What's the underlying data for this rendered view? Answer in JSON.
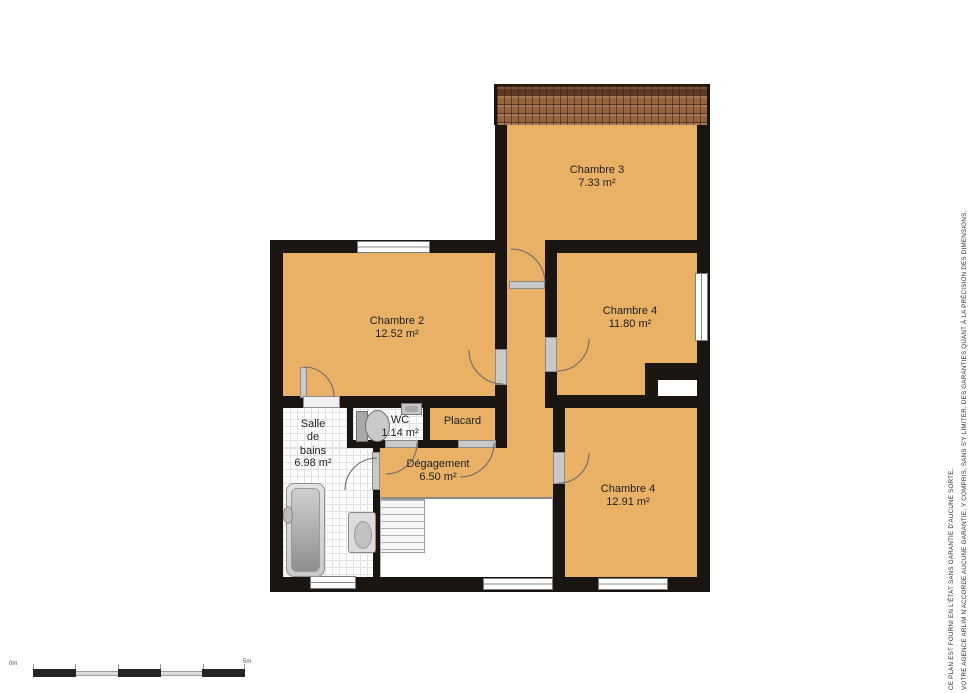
{
  "rooms": [
    {
      "label": "Chambre 3",
      "area": "7.33 m²"
    },
    {
      "label": "Chambre 2",
      "area": "12.52 m²"
    },
    {
      "label": "Chambre 4",
      "area": "11.80 m²"
    },
    {
      "label": "Chambre 4",
      "area": "12.91 m²"
    },
    {
      "label": "Salle de bains",
      "area": "6.98 m²"
    },
    {
      "label": "WC",
      "area": "1.14 m²"
    },
    {
      "label": "Placard",
      "area": ""
    },
    {
      "label": "Dégagement",
      "area": "6.50 m²"
    }
  ],
  "scale_bar": {
    "start_label": "0m",
    "end_label": "5m"
  },
  "disclaimer": {
    "line1": "CE PLAN EST FOURNI EN L'ÉTAT SANS GARANTIE D'AUCUNE SORTE.",
    "line2": "VOTRE AGENCE ARLIM N'ACCORDE AUCUNE GARANTIE, Y COMPRIS, SANS S'Y LIMITER, DES GARANTIES QUANT À LA PRÉCISION DES DIMENSIONS."
  },
  "colors": {
    "floor": "#e9b166",
    "wall": "#1b1511",
    "roof": "#8e5d3b",
    "tile_grid": "#e2e2e2"
  }
}
